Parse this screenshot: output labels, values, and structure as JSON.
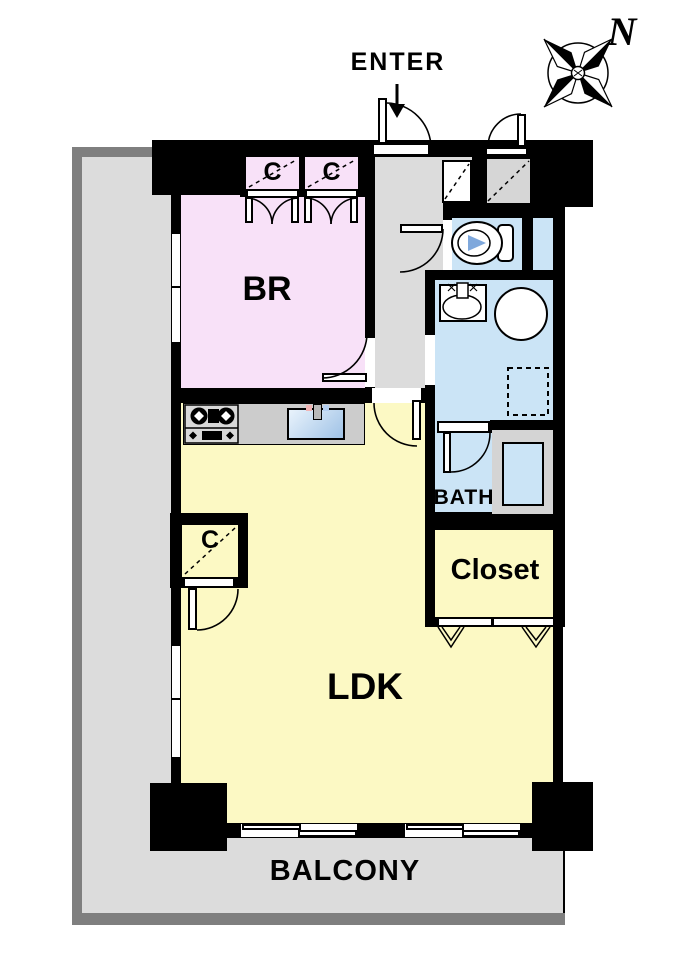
{
  "floor_plan": {
    "entrance": {
      "label": "ENTER"
    },
    "compass": {
      "north_label": "N"
    },
    "rooms": {
      "bedroom": {
        "label": "BR"
      },
      "living_dining_kitchen": {
        "label": "LDK"
      },
      "bathroom": {
        "label": "BATH"
      },
      "closet": {
        "label": "Closet"
      },
      "balcony": {
        "label": "BALCONY"
      },
      "bedroom_closet_left": {
        "label": "C"
      },
      "bedroom_closet_right": {
        "label": "C"
      },
      "ldk_closet": {
        "label": "C"
      }
    },
    "colors": {
      "bedroom": "#f8e1f8",
      "living": "#fcf9c4",
      "wet": "#cbe4f6",
      "balcony": "#dcdcdc",
      "railing": "#7f7f7f",
      "hall": "#dcdcdc",
      "wall": "#000000",
      "counter": "#cccccc",
      "fixture_accent": "#7fa8dc"
    }
  }
}
